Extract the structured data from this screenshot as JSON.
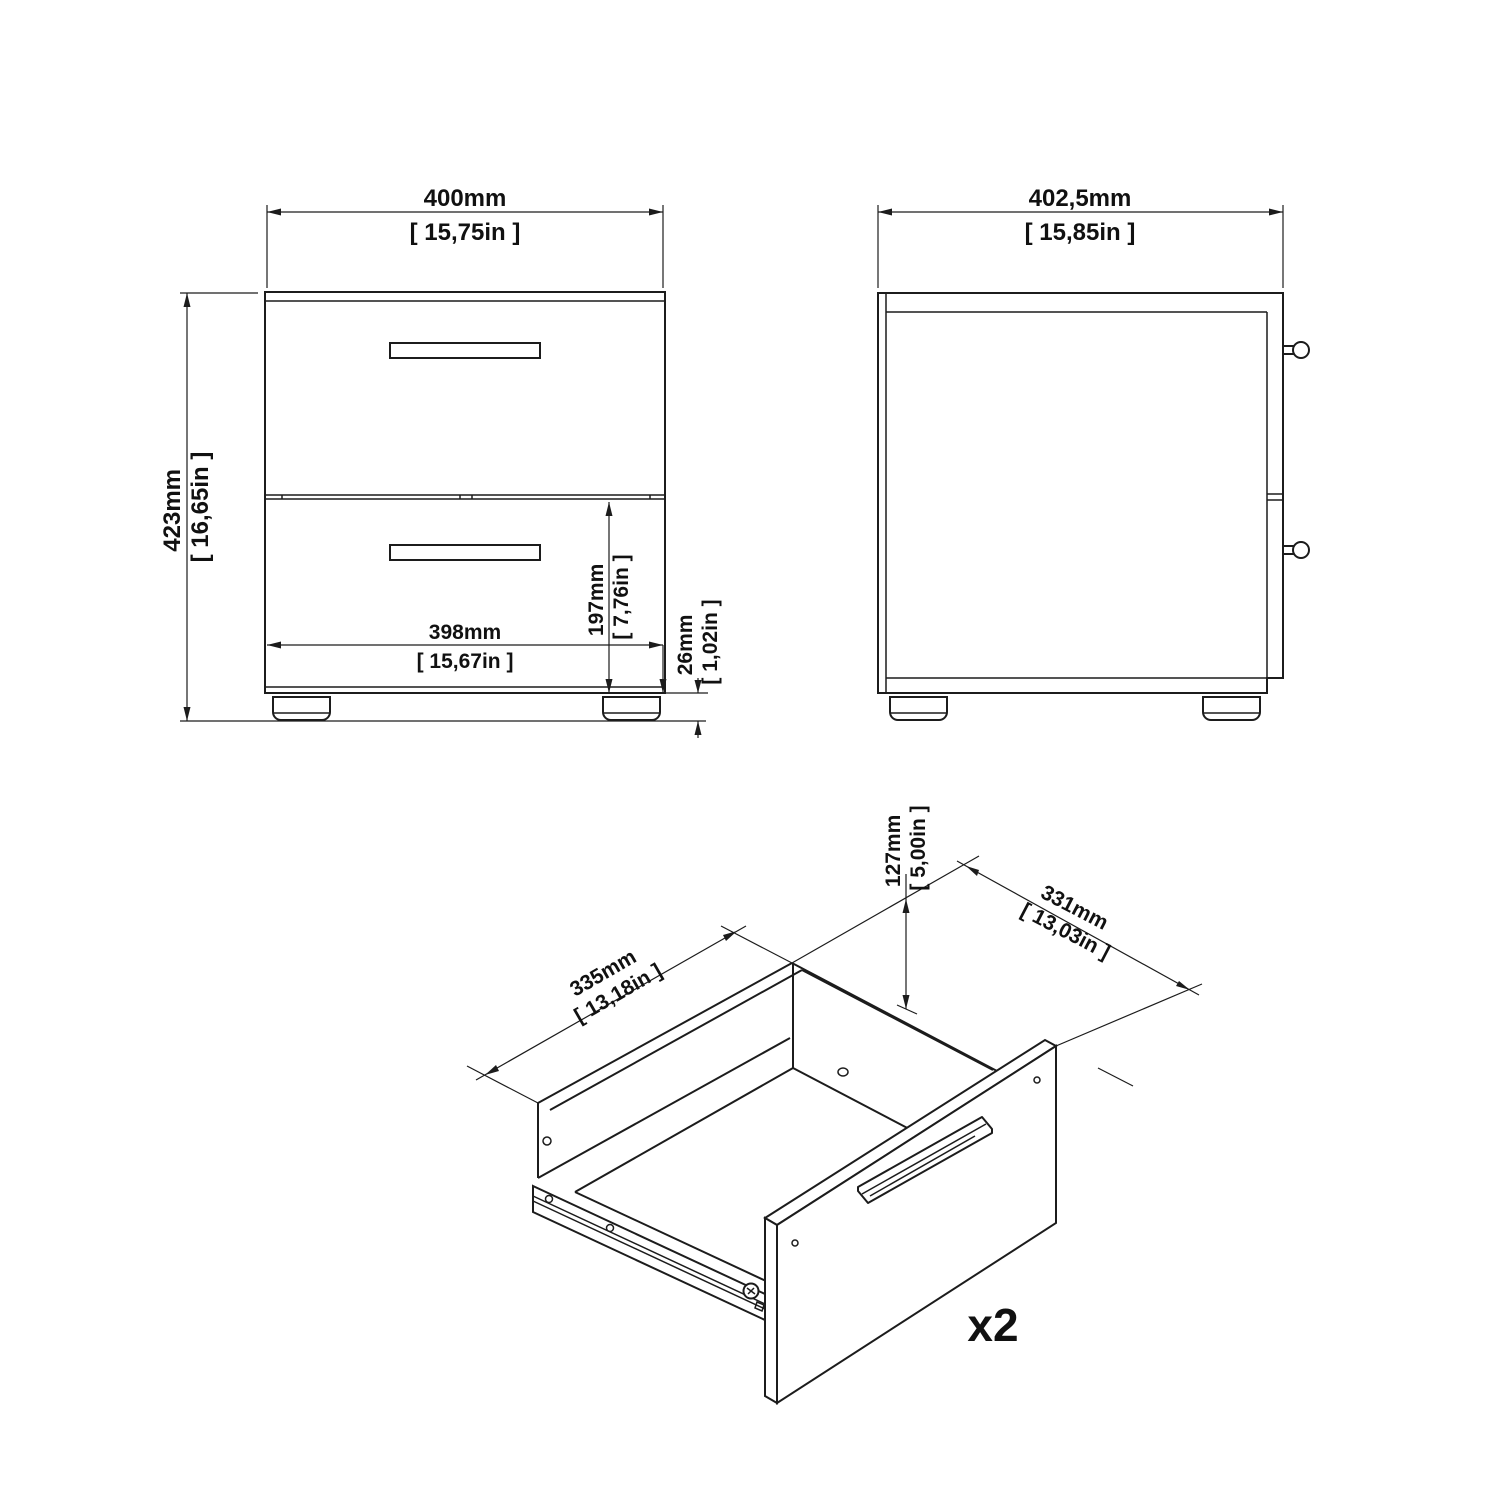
{
  "front_view": {
    "width_mm": "400mm",
    "width_in": "[ 15,75in ]",
    "height_mm": "423mm",
    "height_in": "[ 16,65in ]",
    "inner_width_mm": "398mm",
    "inner_width_in": "[ 15,67in ]",
    "drawer_front_mm": "197mm",
    "drawer_front_in": "[ 7,76in ]",
    "foot_mm": "26mm",
    "foot_in": "[ 1,02in ]"
  },
  "side_view": {
    "depth_mm": "402,5mm",
    "depth_in": "[ 15,85in ]"
  },
  "drawer_view": {
    "inner_length_mm": "335mm",
    "inner_length_in": "[ 13,18in ]",
    "inner_depth_mm": "331mm",
    "inner_depth_in": "[ 13,03in ]",
    "inner_height_mm": "127mm",
    "inner_height_in": "[ 5,00in ]",
    "quantity": "x2"
  },
  "colors": {
    "line": "#1c1c1c",
    "background": "#ffffff"
  }
}
